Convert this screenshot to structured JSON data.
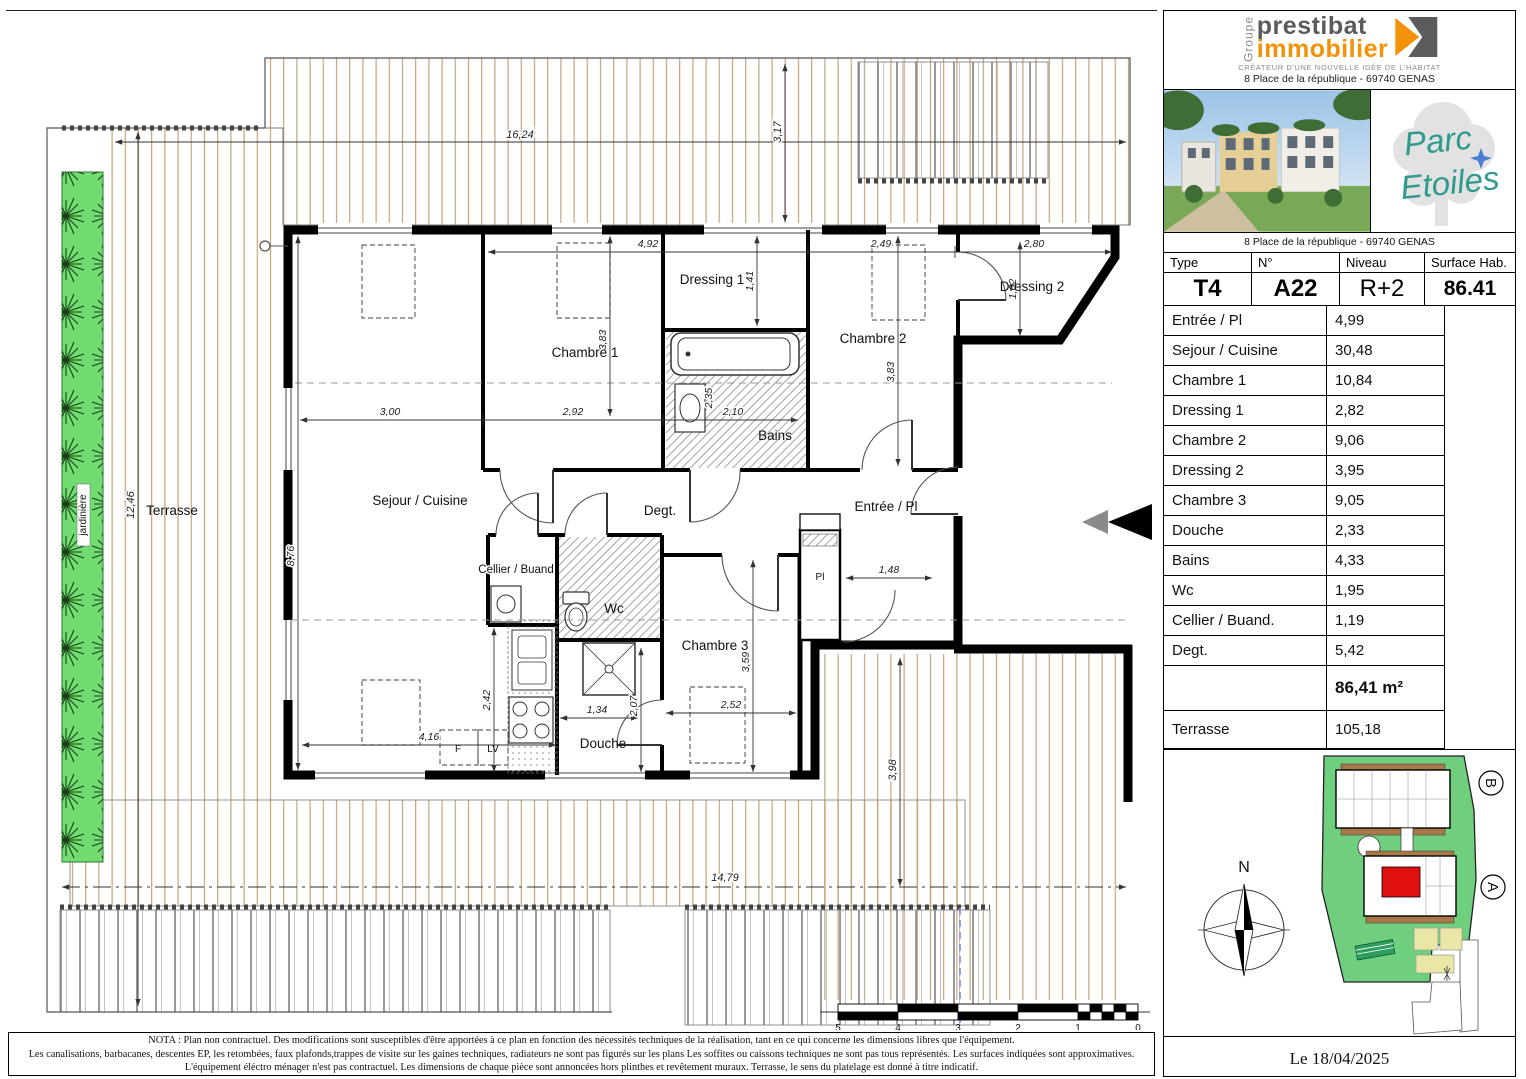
{
  "header_logo": {
    "group_label": "Groupe",
    "brand_line1": "prestibat",
    "brand_line2": "immobilier",
    "tagline": "CRÉATEUR D'UNE NOUVELLE IDÉE DE L'HABITAT",
    "address": "8 Place de la république - 69740 GENAS"
  },
  "project": {
    "name_line1": "Parc",
    "name_line2": "Etoiles",
    "address": "8 Place de la république - 69740 GENAS"
  },
  "unit_header": {
    "type_label": "Type",
    "type_value": "T4",
    "num_label": "N°",
    "num_value": "A22",
    "level_label": "Niveau",
    "level_value": "R+2",
    "surface_label": "Surface Hab.",
    "surface_value": "86.41"
  },
  "rooms_table": {
    "rows": [
      {
        "label": "Entrée / Pl",
        "value": "4,99"
      },
      {
        "label": "Sejour / Cuisine",
        "value": "30,48"
      },
      {
        "label": "Chambre 1",
        "value": "10,84"
      },
      {
        "label": "Dressing 1",
        "value": "2,82"
      },
      {
        "label": "Chambre 2",
        "value": "9,06"
      },
      {
        "label": "Dressing 2",
        "value": "3,95"
      },
      {
        "label": "Chambre 3",
        "value": "9,05"
      },
      {
        "label": "Douche",
        "value": "2,33"
      },
      {
        "label": "Bains",
        "value": "4,33"
      },
      {
        "label": "Wc",
        "value": "1,95"
      },
      {
        "label": "Cellier / Buand.",
        "value": "1,19"
      },
      {
        "label": "Degt.",
        "value": "5,42"
      }
    ],
    "total_value": "86,41 m²",
    "terrace_label": "Terrasse",
    "terrace_value": "105,18"
  },
  "site_plan": {
    "north_label": "N",
    "building_a_label": "A",
    "building_b_label": "B"
  },
  "date_text": "Le 18/04/2025",
  "nota": {
    "line1": "NOTA :    Plan non contractuel. Des modifications sont susceptibles d'être apportées à ce plan en fonction des nécessités techniques de la réalisation, tant en ce qui concerne les dimensions libres que l'équipement.",
    "line2": "Les canalisations, barbacanes, descentes EP, les retombées, faux plafonds,trappes de visite sur les gaines techniques, radiateurs ne sont pas figurés sur les plans Les soffites ou caissons techniques ne sont pas tous représentés. Les surfaces indiquées sont approximatives.",
    "line3": "L'équipement éléctro ménager  n'est pas contractuel. Les dimensions de chaque pièce sont annoncées hors plinthes et revêtement muraux. Terrasse, le sens du platelage est donné à titre indicatif."
  },
  "plan": {
    "labels": {
      "terrasse": "Terrasse",
      "sejour": "Sejour / Cuisine",
      "chambre1": "Chambre 1",
      "dressing1": "Dressing 1",
      "chambre2": "Chambre 2",
      "dressing2": "Dressing 2",
      "chambre3": "Chambre 3",
      "bains": "Bains",
      "douche": "Douche",
      "wc": "Wc",
      "cellier": "Cellier / Buand",
      "degt": "Degt.",
      "entree": "Entrée / Pl",
      "pl": "Pl",
      "f": "F",
      "lv": "LV",
      "jardiniere": "jardinière"
    },
    "dims": {
      "top": "16,24",
      "top_right_v": "3,17",
      "left_v": "12,46",
      "bottom": "14,79",
      "right_v": "3,98",
      "c1_w": "4,92",
      "c2_w": "2,49",
      "d2_w": "2,80",
      "d1_h": "1,41",
      "d2_h": "1,62",
      "c1_h": "3,83",
      "c2_h": "3,83",
      "sejour_w": "3,00",
      "c1_w2": "2,92",
      "sejour_h": "8,76",
      "bains_w": "2,10",
      "bains_h": "2,35",
      "cuisine_h": "2,42",
      "cuisine_w": "4,16",
      "douche_w": "1,34",
      "douche_h": "2,07",
      "c3_w": "2,52",
      "c3_h": "3,59",
      "entree_w": "1,48"
    },
    "scale_ticks": [
      "5",
      "4",
      "3",
      "2",
      "1",
      "0"
    ],
    "colors": {
      "deck_line": "#c49a6c",
      "planter_green": "#72dc72",
      "site_green": "#6fcf7f",
      "unit_red": "#e01010",
      "brand_orange": "#f39208",
      "brand_gray": "#5b5b5d",
      "parc_teal": "#2f9a8d",
      "axis_blue": "#7b8cf0"
    }
  }
}
